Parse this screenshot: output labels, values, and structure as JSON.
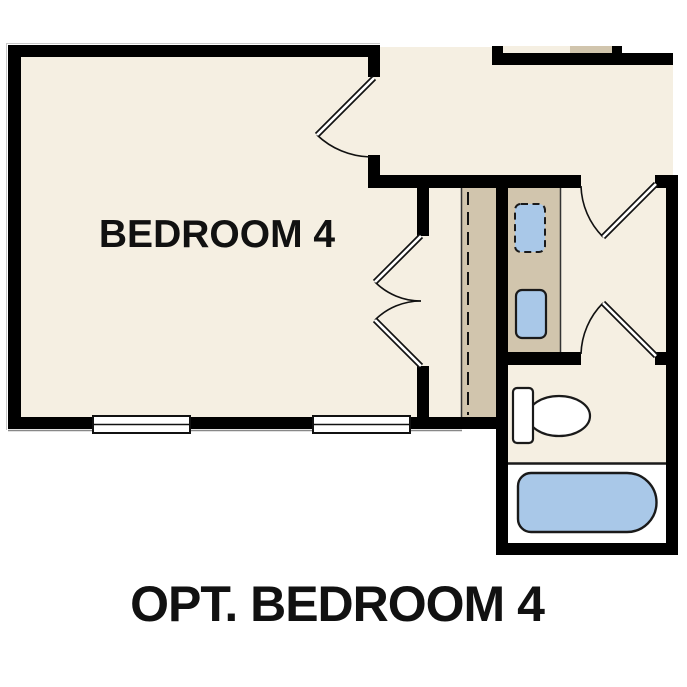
{
  "caption": "OPT. BEDROOM 4",
  "rooms": {
    "bedroom4": {
      "label": "BEDROOM 4"
    }
  },
  "fixtures": {
    "toilet": "toilet-icon",
    "bathtub": "bathtub-icon",
    "sink": "sink-icon",
    "sink_optional": "sink-optional-icon",
    "windows": 2,
    "swing_doors": 5
  },
  "colors": {
    "page": "#ffffff",
    "floor": "#f5efe2",
    "counter": "#d1c5ad",
    "fixture": "#a9c8e8",
    "wall": "#000000",
    "outline": "#1a1a1a"
  }
}
